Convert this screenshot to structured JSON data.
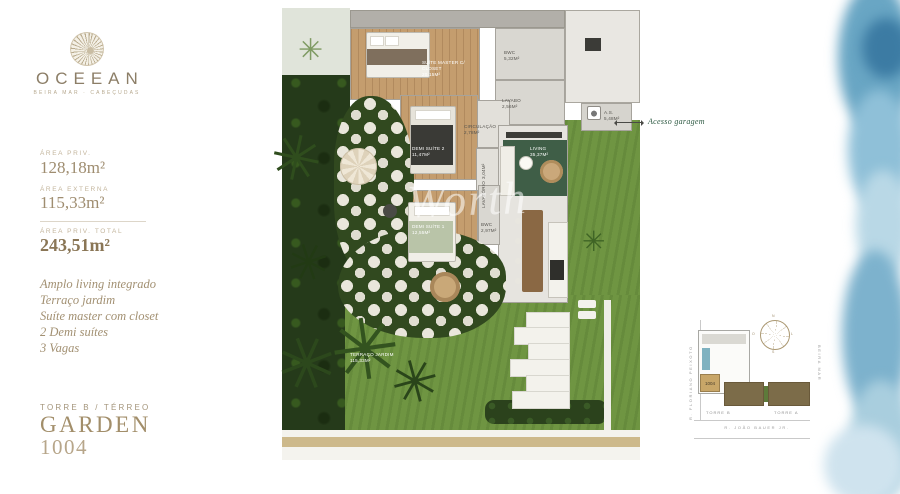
{
  "brand": {
    "name": "OCEEAN",
    "tagline": "BEIRA MAR · CABEÇUDAS"
  },
  "areas": {
    "private": {
      "label": "ÁREA PRIV.",
      "value": "128,18m²"
    },
    "external": {
      "label": "ÁREA EXTERNA",
      "value": "115,33m²"
    },
    "total": {
      "label": "ÁREA PRIV. TOTAL",
      "value": "243,51m²"
    }
  },
  "features": [
    "Amplo living integrado",
    "Terraço jardim",
    "Suíte master com closet",
    "2 Demi suítes",
    "3 Vagas"
  ],
  "unit": {
    "tower_floor": "TORRE B / TÉRREO",
    "type": "GARDEN",
    "number": "1004"
  },
  "floorplan": {
    "rooms": [
      {
        "name": "SUÍTE MASTER C/ CLOSET",
        "area": "20,15m²"
      },
      {
        "name": "BWC",
        "area": "5,32m²"
      },
      {
        "name": "LAVABO",
        "area": "2,56m²"
      },
      {
        "name": "A.S.",
        "area": "5,48m²"
      },
      {
        "name": "CIRCULAÇÃO",
        "area": "2,78m²"
      },
      {
        "name": "DEMI SUÍTE 2",
        "area": "11,47m²"
      },
      {
        "name": "LAVATÓRIO",
        "area": "3,04m²"
      },
      {
        "name": "LIVING",
        "area": "35,37m²"
      },
      {
        "name": "DEMI SUÍTE 1",
        "area": "12,55m²"
      },
      {
        "name": "BWC",
        "area": "2,97m²"
      },
      {
        "name": "TERRAÇO JARDIM",
        "area": "115,33m²"
      }
    ],
    "garage_annotation": "Acesso garagem",
    "watermark": "Worth"
  },
  "siteplan": {
    "street_left": "R. FLORIANO PEIXOTO",
    "street_right": "BEIRA MAR",
    "street_bottom": "R. JOÃO BAUER JR.",
    "tower_left": "TORRE B",
    "tower_right": "TORRE A",
    "unit_highlight": "1004",
    "compass": {
      "n": "N",
      "s": "S",
      "w": "O",
      "e": "L"
    }
  },
  "colors": {
    "accent_gold": "#a28e6a",
    "annotation_green": "#2e5a43",
    "watercolor_blue": "#6ea9c6"
  }
}
